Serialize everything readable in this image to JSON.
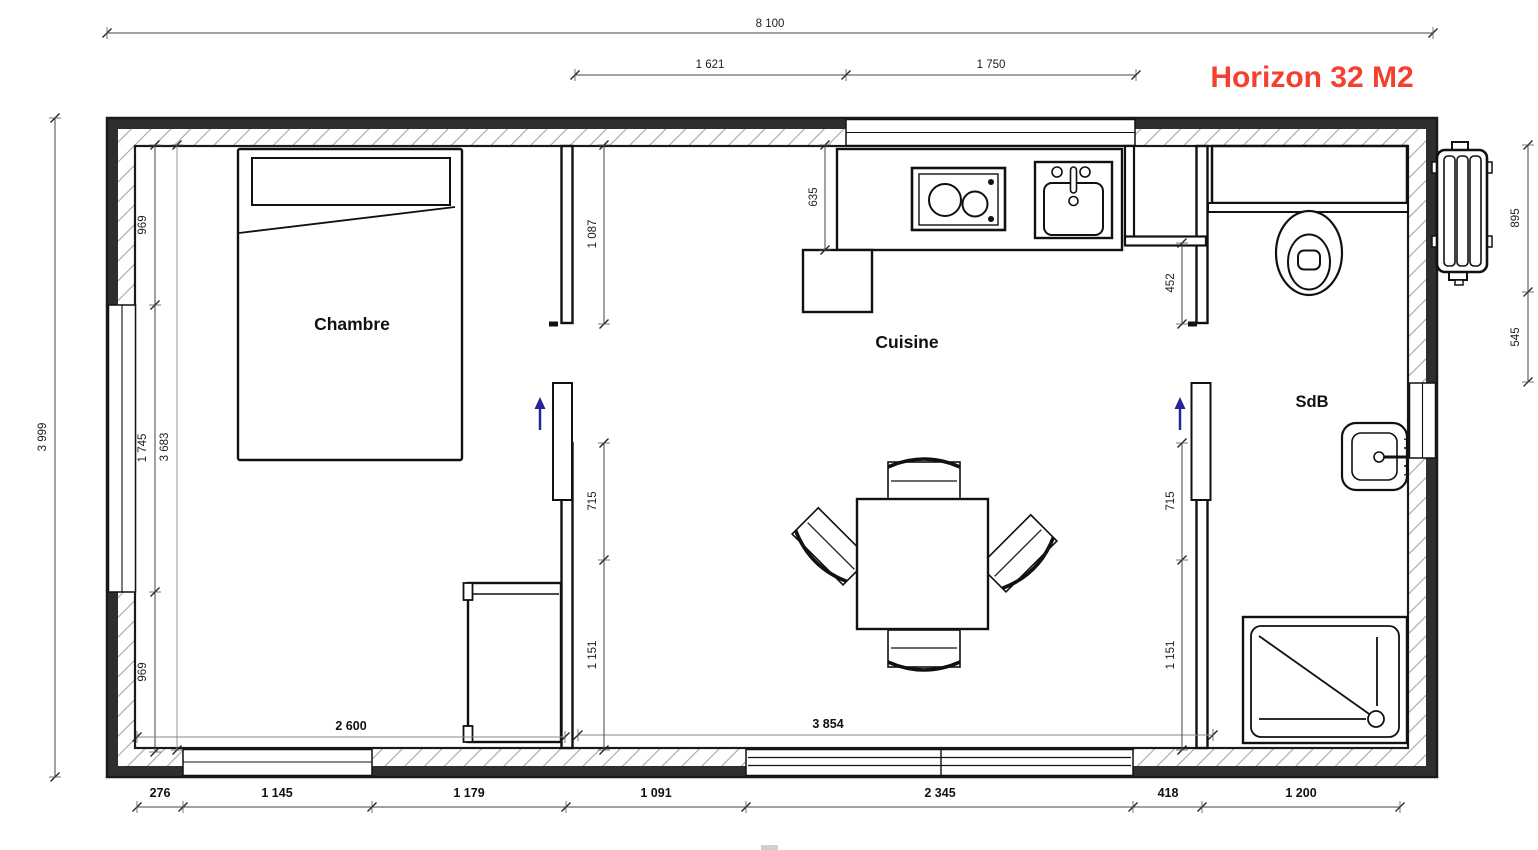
{
  "title": {
    "text": "Horizon 32 M2",
    "color": "#f4402e"
  },
  "rooms": {
    "bedroom": "Chambre",
    "kitchen": "Cuisine",
    "bathroom": "SdB"
  },
  "icons": {
    "door_arrow": "slide-direction-arrow",
    "arrow_color": "#26269b"
  },
  "dims": {
    "overall_width": "8 100",
    "overall_height": "3 999",
    "top": [
      "1 621",
      "1 750"
    ],
    "left": [
      "969",
      "1 745",
      "969"
    ],
    "right": [
      "895",
      "545"
    ],
    "bottom": [
      "276",
      "1 145",
      "1 179",
      "1 091",
      "2 345",
      "418",
      "1 200"
    ],
    "interior": {
      "bedroom_width": "2 600",
      "living_width": "3 854",
      "bedroom_height": "3 683",
      "kitchen_depth": "635",
      "partition_top": "1 087",
      "partition_mid": "715",
      "partition_bottom": "1 151",
      "bath_top": "452",
      "bath_mid": "715",
      "bath_bottom": "1 151"
    }
  }
}
